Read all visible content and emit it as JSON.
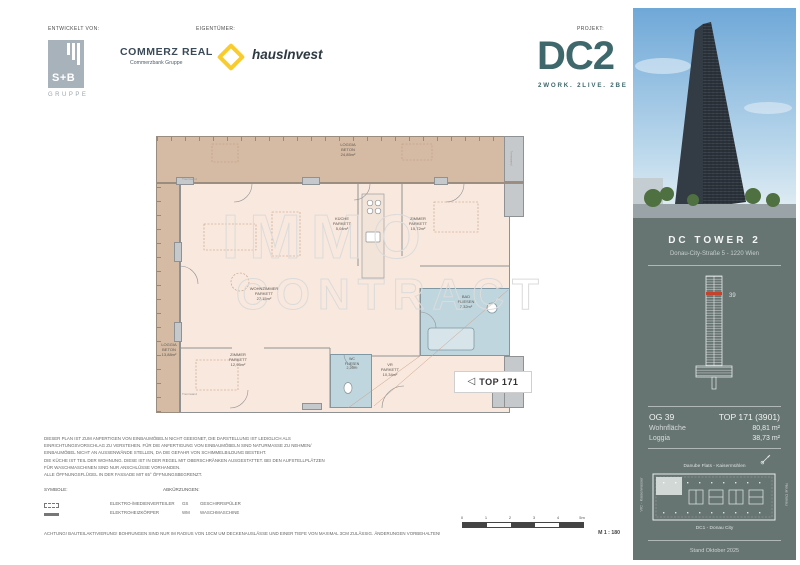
{
  "colors": {
    "sidebar_teal": "#667472",
    "brand_teal": "#3E686C",
    "floor_highlight_red": "#C5432D",
    "commerzbank_yellow": "#F9CC2E",
    "loggia_tan": "#D5BBA4",
    "interior_cream": "#F9E8DD",
    "wet_room_blue": "#BFD6DE"
  },
  "header": {
    "developed_by_label": "ENTWICKELT VON:",
    "owner_label": "EIGENTÜMER:",
    "project_label": "PROJEKT:",
    "sb_logo": {
      "name": "S+B",
      "sub": "GRUPPE"
    },
    "commerz_real": {
      "name": "COMMERZ REAL",
      "sub": "Commerzbank Gruppe"
    },
    "hausinvest": "hausInvest",
    "dc2": {
      "wordmark": "DC2",
      "tagline": "2WORK. 2LIVE. 2BE"
    }
  },
  "plan": {
    "watermark_line1": "IMMO",
    "watermark_line2": "CONTRACT",
    "trennwand": "Trennwand",
    "top_marker": "TOP 171",
    "rooms": {
      "loggia_top": {
        "name": "LOGGIA",
        "material": "BETON",
        "area": "24,85m²"
      },
      "loggia_left": {
        "name": "LOGGIA",
        "material": "BETON",
        "area": "13,88m²"
      },
      "kueche": {
        "name": "KÜCHE",
        "material": "PARKETT",
        "area": "5,04m²"
      },
      "zimmer_1": {
        "name": "ZIMMER",
        "material": "PARKETT",
        "area": "15,72m²"
      },
      "wohnzimmer": {
        "name": "WOHNZIMMER",
        "material": "PARKETT",
        "area": "27,15m²"
      },
      "zimmer_2": {
        "name": "ZIMMER",
        "material": "PARKETT",
        "area": "12,95m²"
      },
      "wc": {
        "name": "WC",
        "material": "FLIESEN",
        "area": "2,29m²"
      },
      "vr": {
        "name": "VR",
        "material": "PARKETT",
        "area": "10,34m²"
      },
      "bad": {
        "name": "BAD",
        "material": "FLIESEN",
        "area": "7,32m²"
      }
    }
  },
  "notes": {
    "lines": [
      "DIESER PLAN IST ZUM ANFERTIGEN VON EINBAUMÖBELN NICHT GEEIGNET, DIE DARSTELLUNG IST LEDIGLICH ALS",
      "EINRICHTUNGSVORSCHLAG ZU VERSTEHEN. FÜR DIE ANFERTIGUNG VON EINBAUMÖBELN SIND NATURMASSE ZU NEHMEN/",
      "EINBAUMÖBEL NICHT AN AUSSENWÄNDE STELLEN, DA DIE GEFAHR VON SCHIMMELBILDUNG BESTEHT.",
      "DIE KÜCHE IST TEIL DER WOHNUNG. DIESE IST IN DER REGEL MIT OBERSCHRÄNKEN AUSGESTATTET. BEI DEN AUFSTELLPLÄTZEN",
      "FÜR WASCHMASCHINEN SIND NUR ANSCHLÜSSE VORHANDEN.",
      "ALLE ÖFFNUNGSFLÜGEL IN DER FASSADE MIT 65° ÖFFNUNGSBEGRENZT."
    ]
  },
  "legend": {
    "symbols_label": "SYMBOLE:",
    "symbols": [
      {
        "label": "ELEKTRO-/MEDIENVERTEILER"
      },
      {
        "label": "ELEKTROHEIZKÖRPER"
      }
    ],
    "abbreviations_label": "ABKÜRZUNGEN:",
    "abbreviations": [
      {
        "key": "GS",
        "label": "GESCHIRRSPÜLER"
      },
      {
        "key": "WM",
        "label": "WASCHMASCHINE"
      }
    ]
  },
  "warning": "ACHTUNG! BAUTEILAKTIVIERUNG! BOHRUNGEN SIND NUR IM RADIUS VON 10CM UM DECKENAUSLÄSSE UND EINER TIEFE VON MAXIMAL 3CM ZULÄSSIG. ÄNDERUNGEN VORBEHALTEN!",
  "scale": {
    "ticks": [
      "0",
      "1",
      "2",
      "3",
      "4",
      "5m"
    ],
    "label": "M 1 : 180"
  },
  "sidebar": {
    "building_name": "DC TOWER 2",
    "address": "Donau-City-Straße 5 - 1220 Wien",
    "elevation_floor": "39",
    "floor": "OG 39",
    "unit": "TOP 171 (3901)",
    "areas": [
      {
        "label": "Wohnfläche",
        "value": "80,81 m²"
      },
      {
        "label": "Loggia",
        "value": "38,73 m²"
      }
    ],
    "siteplan": {
      "top": "Danube Flats - Kaisermühlen",
      "left": "VIC - Kaiserwasser",
      "right": "Neue Donau",
      "bottom": "DC1 - Donau City"
    },
    "date": "Stand Oktober 2025"
  }
}
